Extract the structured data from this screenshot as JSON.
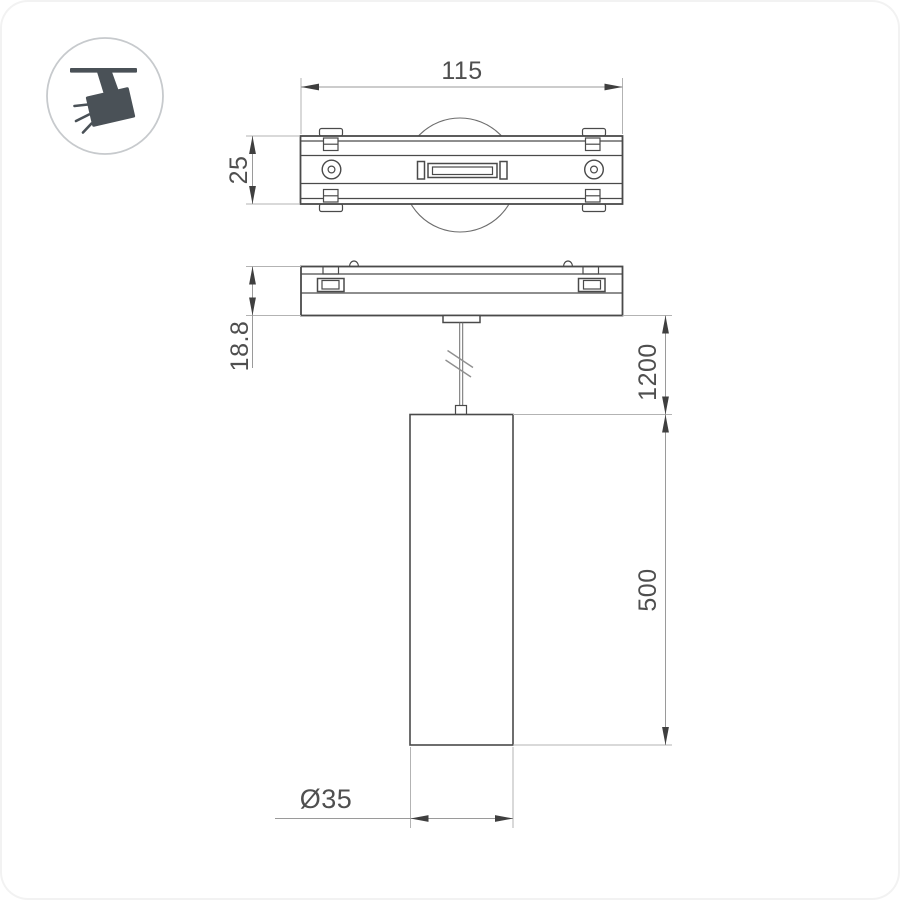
{
  "drawing": {
    "icon": {
      "name": "track-spotlight"
    },
    "dims": {
      "adapter_width": "115",
      "adapter_depth": "25",
      "adapter_height": "18.8",
      "suspension_length": "1200",
      "lamp_height": "500",
      "lamp_diameter": "Ø35"
    },
    "colors": {
      "background": "#ffffff",
      "object_line": "#4a4a4a",
      "dimension_line": "#9a9a9a",
      "extension_line": "#b3b3b3",
      "arrow": "#3f3f3f",
      "text": "#4f4f4f",
      "icon": "#4a5157",
      "icon_ring": "#c7cacd"
    }
  }
}
